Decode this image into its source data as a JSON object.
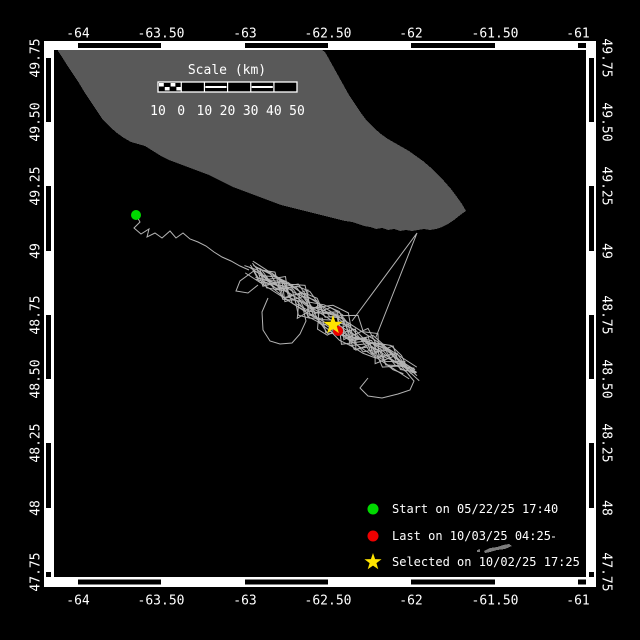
{
  "canvas": {
    "width": 640,
    "height": 640,
    "background": "#000000"
  },
  "colors": {
    "frame": "#ffffff",
    "land": "#595959",
    "islet": "#7d7d7d",
    "track": "#b4b4b4",
    "start_marker": "#00d900",
    "last_marker": "#ee0000",
    "selected_marker": "#ffe400",
    "text": "#ffffff"
  },
  "axes": {
    "top_labels": [
      "-64",
      "-63.50",
      "-63",
      "-62.50",
      "-62",
      "-61.50",
      "-61"
    ],
    "bottom_labels": [
      "-64",
      "-63.50",
      "-63",
      "-62.50",
      "-62",
      "-61.50",
      "-61"
    ],
    "left_labels": [
      "49.75",
      "49.50",
      "49.25",
      "49",
      "48.75",
      "48.50",
      "48.25",
      "48",
      "47.75"
    ],
    "right_labels": [
      "49.75",
      "49.50",
      "49.25",
      "49",
      "48.75",
      "48.50",
      "48.25",
      "48",
      "47.75"
    ],
    "lon_ticks_x": [
      78,
      161,
      245,
      328,
      411,
      495,
      578
    ],
    "lat_ticks_y": [
      58,
      122,
      186,
      251,
      315,
      379,
      443,
      508,
      572
    ],
    "interior": {
      "x1": 54,
      "y1": 50,
      "x2": 586,
      "y2": 577
    },
    "top_label_y": 34,
    "bottom_label_y": 601,
    "left_label_x": 36,
    "right_label_x": 606
  },
  "scalebar": {
    "title": "Scale (km)",
    "title_x": 227,
    "title_y": 64,
    "x1": 158,
    "x2": 297,
    "y1": 82,
    "y2": 92,
    "labels": [
      "10",
      "0",
      "10",
      "20",
      "30",
      "40",
      "50"
    ],
    "label_y": 105,
    "segments": [
      "checker",
      "solid",
      "striped",
      "solid",
      "striped",
      "solid"
    ]
  },
  "legend": {
    "marker_x": 373,
    "text_x": 392,
    "rows": [
      {
        "marker": "circle",
        "color_key": "start_marker",
        "label": "Start on 05/22/25 17:40",
        "y": 509
      },
      {
        "marker": "circle",
        "color_key": "last_marker",
        "label": "Last on 10/03/25 04:25",
        "y": 536
      },
      {
        "marker": "star",
        "color_key": "selected_marker",
        "label": "Selected on 10/02/25 17:25",
        "y": 562
      }
    ]
  },
  "geography": {
    "island": {
      "name": "anticosti-island",
      "points": [
        [
          58,
          50
        ],
        [
          58,
          51
        ],
        [
          62,
          57
        ],
        [
          67,
          65
        ],
        [
          73,
          74
        ],
        [
          79,
          83
        ],
        [
          85,
          93
        ],
        [
          91,
          102
        ],
        [
          97,
          111
        ],
        [
          103,
          120
        ],
        [
          110,
          127
        ],
        [
          117,
          133
        ],
        [
          124,
          138
        ],
        [
          131,
          142
        ],
        [
          138,
          144
        ],
        [
          145,
          146
        ],
        [
          153,
          151
        ],
        [
          161,
          156
        ],
        [
          169,
          160
        ],
        [
          177,
          163
        ],
        [
          185,
          166
        ],
        [
          193,
          169
        ],
        [
          201,
          172
        ],
        [
          209,
          175
        ],
        [
          217,
          179
        ],
        [
          225,
          183
        ],
        [
          233,
          187
        ],
        [
          241,
          190
        ],
        [
          249,
          193
        ],
        [
          257,
          196
        ],
        [
          265,
          199
        ],
        [
          273,
          202
        ],
        [
          281,
          205
        ],
        [
          289,
          207
        ],
        [
          297,
          209
        ],
        [
          305,
          211
        ],
        [
          313,
          213
        ],
        [
          321,
          215
        ],
        [
          329,
          217
        ],
        [
          337,
          219
        ],
        [
          345,
          221
        ],
        [
          352,
          222
        ],
        [
          358,
          224
        ],
        [
          364,
          226
        ],
        [
          370,
          227
        ],
        [
          376,
          229
        ],
        [
          382,
          228
        ],
        [
          388,
          230
        ],
        [
          394,
          229
        ],
        [
          400,
          231
        ],
        [
          406,
          230
        ],
        [
          412,
          231
        ],
        [
          418,
          230
        ],
        [
          424,
          229
        ],
        [
          430,
          230
        ],
        [
          436,
          229
        ],
        [
          442,
          227
        ],
        [
          448,
          224
        ],
        [
          454,
          220
        ],
        [
          459,
          216
        ],
        [
          463,
          213
        ],
        [
          466,
          211
        ],
        [
          462,
          204
        ],
        [
          457,
          197
        ],
        [
          451,
          189
        ],
        [
          444,
          181
        ],
        [
          437,
          174
        ],
        [
          430,
          167
        ],
        [
          423,
          161
        ],
        [
          416,
          156
        ],
        [
          409,
          151
        ],
        [
          402,
          147
        ],
        [
          395,
          143
        ],
        [
          388,
          139
        ],
        [
          381,
          134
        ],
        [
          374,
          128
        ],
        [
          367,
          121
        ],
        [
          361,
          113
        ],
        [
          355,
          104
        ],
        [
          349,
          95
        ],
        [
          344,
          86
        ],
        [
          339,
          77
        ],
        [
          334,
          68
        ],
        [
          329,
          59
        ],
        [
          325,
          52
        ],
        [
          322,
          50
        ]
      ]
    },
    "islets": [
      {
        "name": "islet-chain",
        "points": [
          [
            484,
            551
          ],
          [
            490,
            548
          ],
          [
            497,
            547
          ],
          [
            503,
            545
          ],
          [
            509,
            544
          ],
          [
            512,
            546
          ],
          [
            505,
            549
          ],
          [
            497,
            550
          ],
          [
            490,
            552
          ],
          [
            485,
            553
          ]
        ]
      },
      {
        "name": "islet-dot-1",
        "points": [
          [
            477,
            550
          ],
          [
            480,
            549
          ],
          [
            480,
            552
          ],
          [
            477,
            552
          ]
        ]
      },
      {
        "name": "islet-dot-2",
        "points": [
          [
            552,
            536
          ],
          [
            555,
            536
          ],
          [
            555,
            538
          ],
          [
            552,
            538
          ]
        ]
      }
    ]
  },
  "track": {
    "start_point": [
      136,
      215
    ],
    "last_point": [
      338,
      331
    ],
    "selected_point": [
      333,
      325
    ],
    "lead_in": [
      [
        136,
        215
      ],
      [
        140,
        222
      ],
      [
        134,
        228
      ],
      [
        141,
        234
      ],
      [
        149,
        229
      ],
      [
        147,
        237
      ],
      [
        155,
        233
      ],
      [
        162,
        238
      ],
      [
        170,
        231
      ],
      [
        176,
        238
      ],
      [
        183,
        233
      ],
      [
        190,
        239
      ],
      [
        198,
        242
      ],
      [
        206,
        246
      ],
      [
        214,
        252
      ],
      [
        222,
        257
      ],
      [
        231,
        261
      ],
      [
        240,
        266
      ],
      [
        249,
        270
      ]
    ],
    "band": {
      "a": [
        249,
        267
      ],
      "b": [
        413,
        373
      ],
      "half_width": 16,
      "strands": 16,
      "seed": 7
    },
    "axis_lines": 3,
    "loops": [
      [
        [
          255,
          270
        ],
        [
          240,
          281
        ],
        [
          236,
          291
        ],
        [
          248,
          293
        ],
        [
          258,
          285
        ]
      ],
      [
        [
          268,
          298
        ],
        [
          262,
          312
        ],
        [
          263,
          330
        ],
        [
          270,
          341
        ],
        [
          280,
          344
        ],
        [
          292,
          343
        ],
        [
          300,
          334
        ],
        [
          306,
          321
        ],
        [
          303,
          308
        ],
        [
          296,
          300
        ]
      ],
      [
        [
          368,
          378
        ],
        [
          360,
          388
        ],
        [
          368,
          396
        ],
        [
          382,
          398
        ],
        [
          398,
          394
        ],
        [
          410,
          390
        ],
        [
          414,
          381
        ],
        [
          408,
          374
        ]
      ]
    ],
    "spike": [
      [
        352,
        321
      ],
      [
        417,
        233
      ],
      [
        376,
        337
      ]
    ]
  }
}
